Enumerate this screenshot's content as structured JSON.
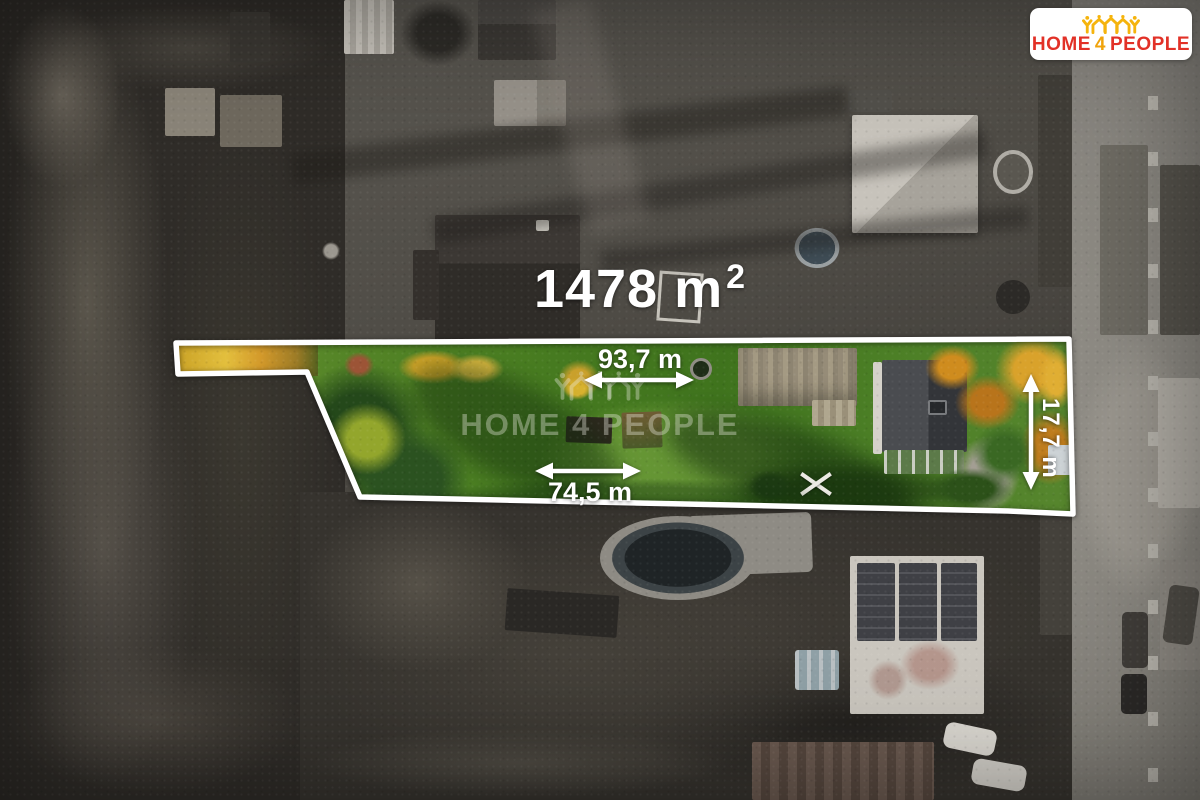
{
  "badge": {
    "part1": "HOME",
    "part2": "4",
    "part3": "PEOPLE",
    "icon": "houses-crown-icon",
    "background": "#ffffff",
    "red": "#e23127",
    "yellow": "#f0a30b"
  },
  "watermark": {
    "text": "HOME 4 PEOPLE",
    "icon": "houses-crown-icon"
  },
  "annotations": {
    "area": {
      "value": "1478 m",
      "sup": "2"
    },
    "top_width": "93,7 m",
    "bottom_width": "74,5 m",
    "right_depth": "17,7 m",
    "outline_color": "#ffffff"
  }
}
